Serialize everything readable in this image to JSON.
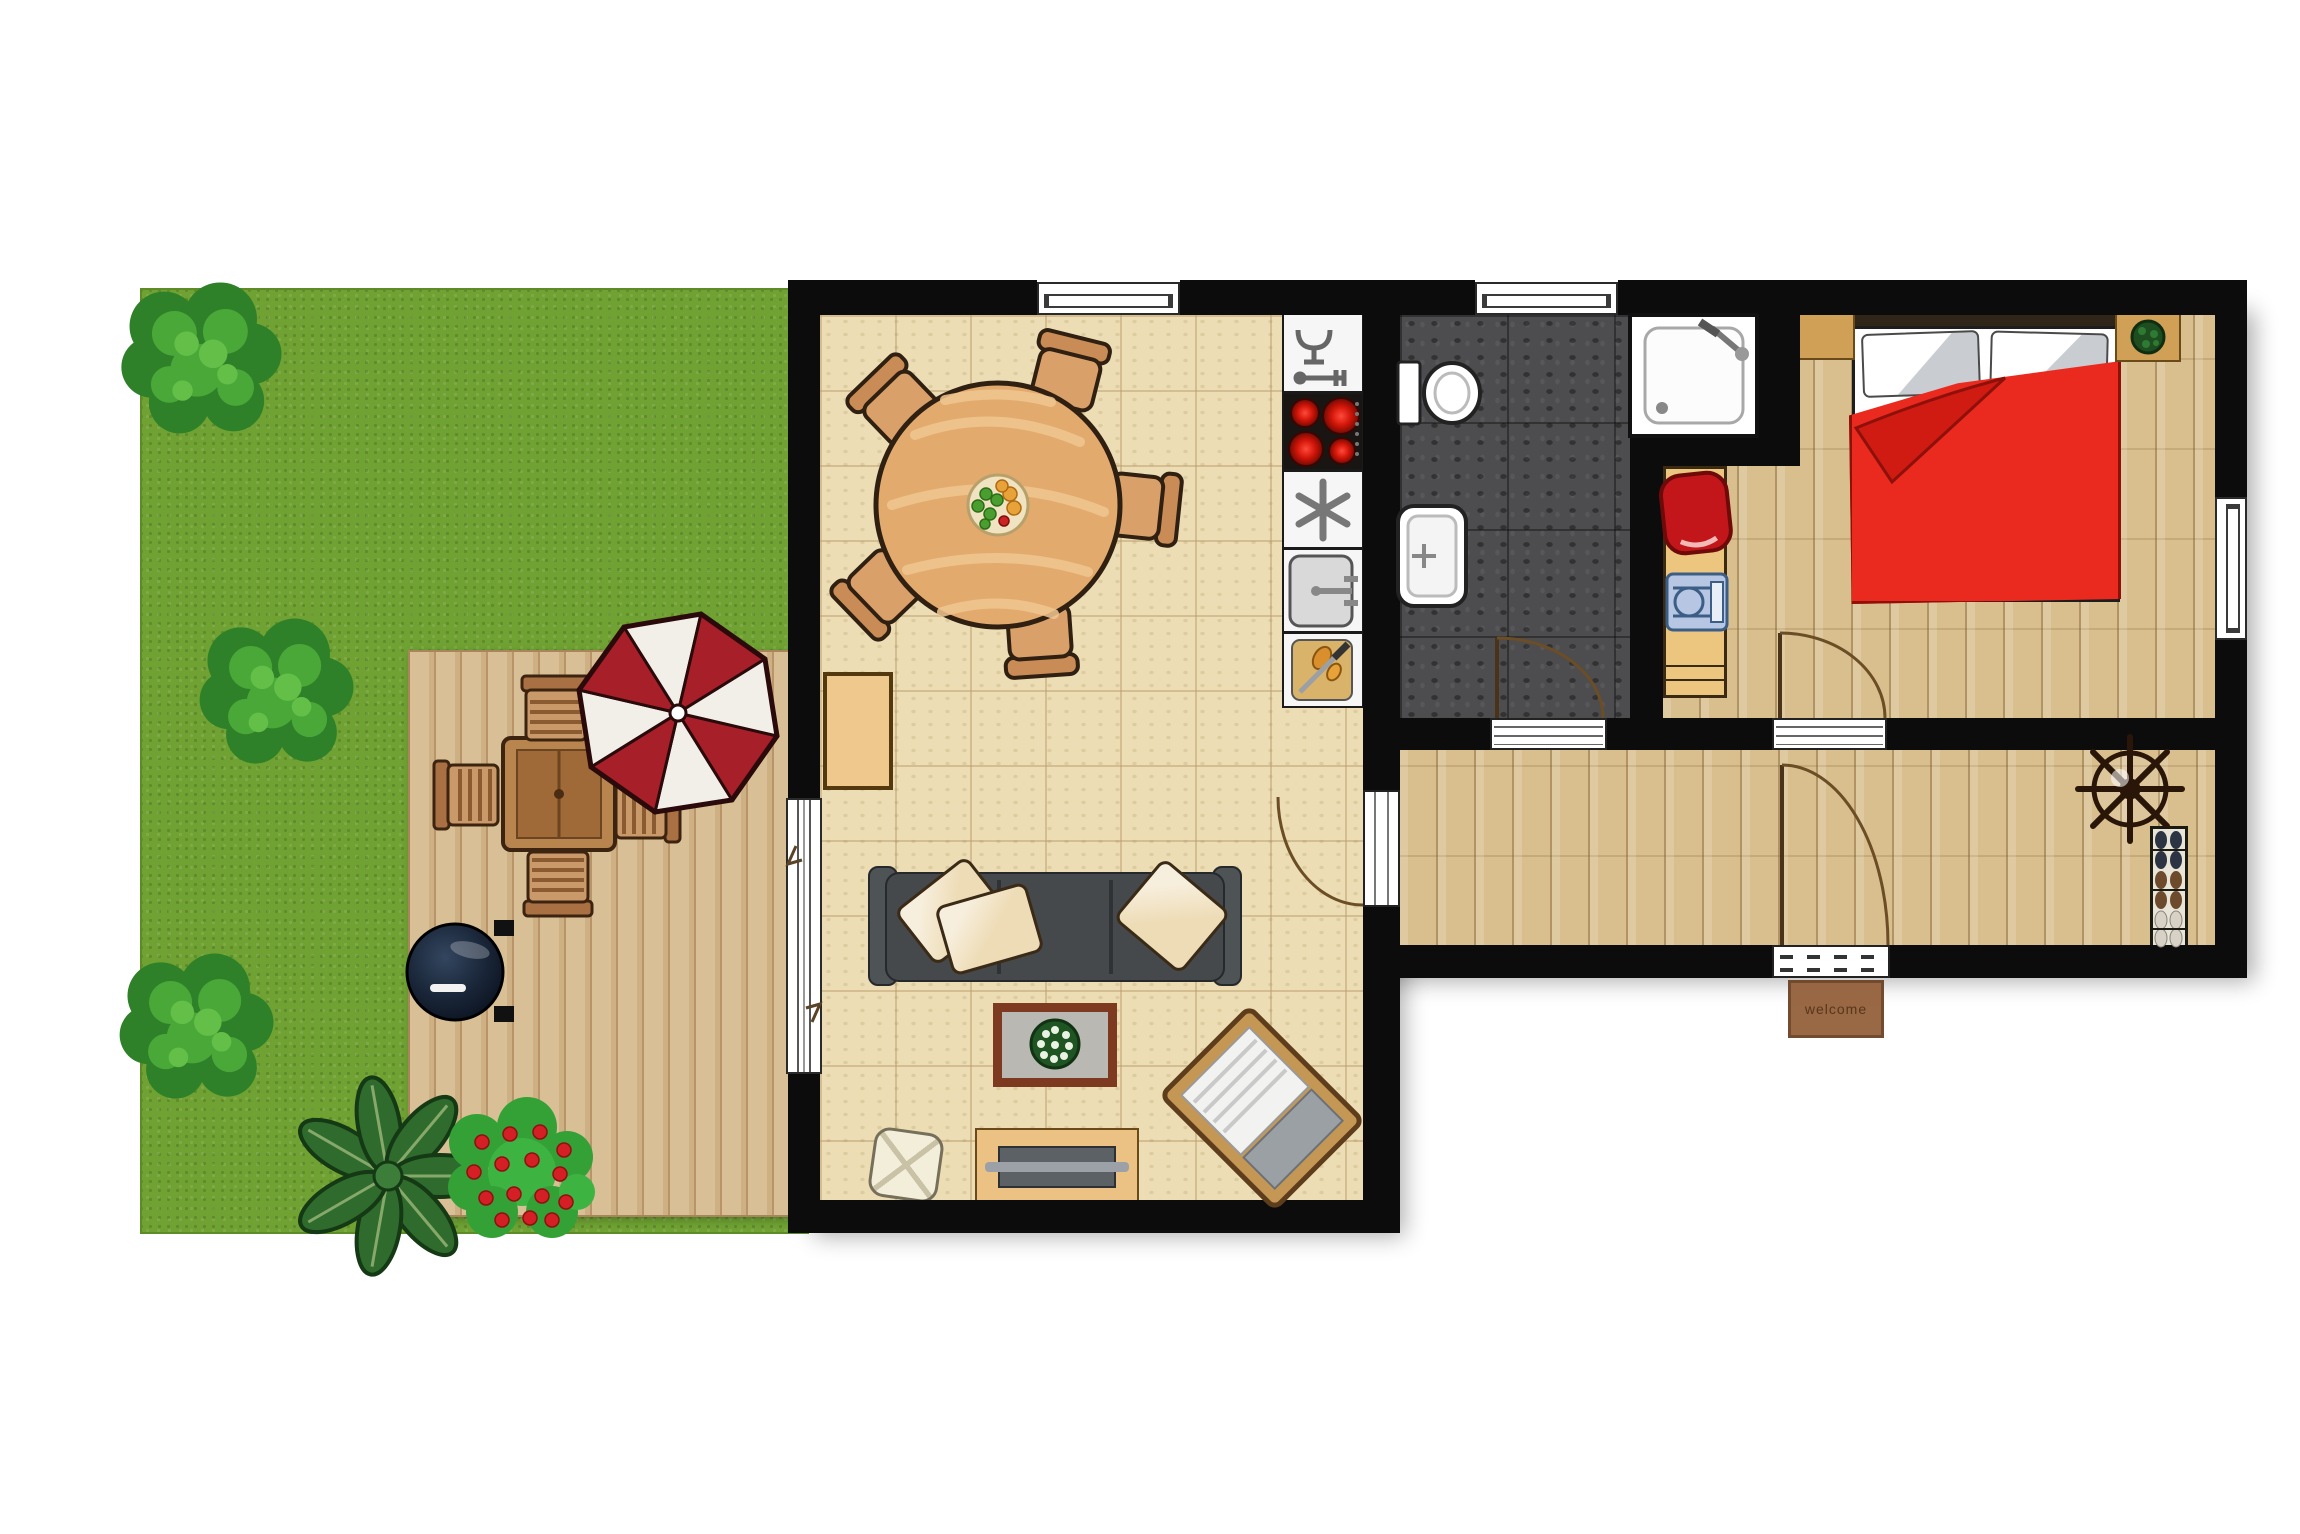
{
  "scene": {
    "title": "apartment-floor-plan-with-garden",
    "doormat_text": "welcome"
  },
  "palette": {
    "wall": "#0c0c0c",
    "lawn_green": "#6fa233",
    "deck_wood": "#d8bf95",
    "tile_floor": "#ecddb4",
    "parquet_floor": "#d9bf8e",
    "bathroom_floor": "#4d4d4f",
    "duvet_red": "#ea2a1e",
    "sofa_gray": "#45494c",
    "umbrella_red": "#a71f29",
    "outdoor_wood": "#b9854f"
  },
  "garden": {
    "items": [
      "tree",
      "tree",
      "tree",
      "leaf-plant",
      "flower-bush-red-blooms",
      "wooden-deck",
      "square-patio-table",
      "patio-chair x4",
      "red-white-parasol",
      "kettle-grill"
    ]
  },
  "living_room": {
    "items": [
      "round-dining-table",
      "dining-chair x5",
      "fruit-bowl",
      "dishwasher",
      "cooktop-4-burners",
      "freezer",
      "kitchen-sink",
      "counter-with-cutting-board",
      "side-table",
      "sofa-3-seat",
      "sofa-pillow x3",
      "coffee-table",
      "potted-plant",
      "tv-console",
      "tv",
      "pouf",
      "lounge-chair",
      "sliding-patio-door",
      "window",
      "door-to-hallway"
    ]
  },
  "bathroom": {
    "items": [
      "toilet",
      "washbasin",
      "shower-tray",
      "window",
      "door"
    ]
  },
  "bedroom": {
    "items": [
      "double-bed",
      "bed-pillow x2",
      "red-duvet",
      "nightstand x2",
      "plant-on-nightstand",
      "desk",
      "red-chair",
      "blue-stool",
      "window",
      "door"
    ]
  },
  "hallway": {
    "items": [
      "coat-stand",
      "shoe-rack-6-pairs",
      "front-door",
      "doormat"
    ]
  }
}
